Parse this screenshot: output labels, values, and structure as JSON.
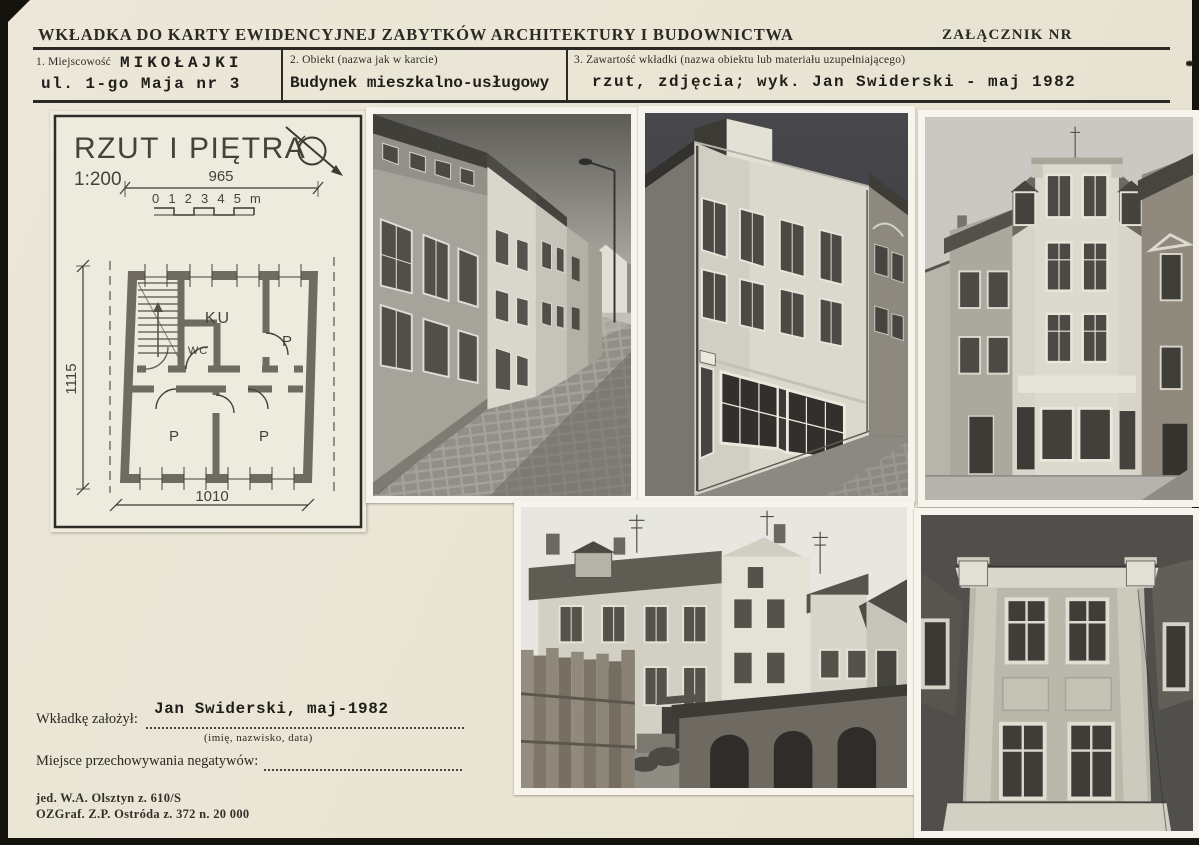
{
  "card": {
    "header": {
      "title": "WKŁADKA DO KARTY EWIDENCYJNEJ ZABYTKÓW ARCHITEKTURY I BUDOWNICTWA",
      "attachment_label": "ZAŁĄCZNIK NR"
    },
    "fields": [
      {
        "label": "1. Miejscowość",
        "value_line1": "MIKOŁAJKI",
        "value_line2": "ul. 1-go Maja nr 3"
      },
      {
        "label": "2. Obiekt (nazwa jak w karcie)",
        "value": "Budynek mieszkalno-usługowy"
      },
      {
        "label": "3. Zawartość wkładki (nazwa obiektu lub materiału uzupełniającego)",
        "value": "rzut, zdjęcia; wyk. Jan Swiderski - maj 1982"
      }
    ],
    "plan": {
      "title": "RZUT I PIĘTRA",
      "scale": "1:200",
      "scale_bar": "0 1 2 3 4 5 m",
      "dim_top": "965",
      "dim_left": "1115",
      "dim_bottom": "1010",
      "room_labels": [
        "KU",
        "P",
        "WC",
        "P",
        "P"
      ]
    },
    "photos": [
      {
        "alt": "Street view with cobblestone roadway and row of tenement houses"
      },
      {
        "alt": "Three-storey corner tenement with shopfront on the ground floor"
      },
      {
        "alt": "Front facade of the residential-commercial building"
      },
      {
        "alt": "Courtyard elevation with wooden fence and outbuilding"
      },
      {
        "alt": "Close-up of the central facade bay with four windows"
      }
    ],
    "footer": {
      "founder_label": "Wkładkę założył:",
      "founder_value": "Jan Swiderski, maj-1982",
      "founder_hint": "(imię, nazwisko, data)",
      "negatives_label": "Miejsce przechowywania negatywów:",
      "imprint_line1": "jed. W.A. Olsztyn z. 610/S",
      "imprint_line2": "OZGraf. Z.P. Ostróda z. 372 n. 20 000"
    },
    "colors": {
      "card_bg": "#e9e4d4",
      "scan_edge": "#15130e",
      "ink": "#2b2924",
      "plan_paper": "#edeade"
    }
  }
}
